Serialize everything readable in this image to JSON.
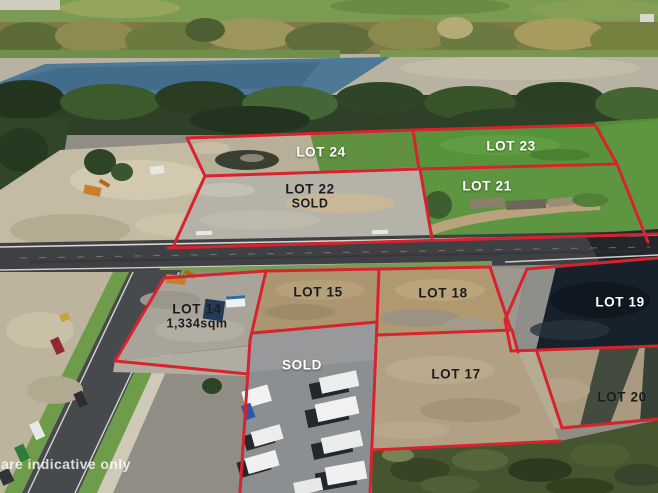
{
  "image": {
    "kind": "aerial-drone-photo-of-subdivision",
    "width_px": 658,
    "height_px": 493
  },
  "watermark": {
    "text": "are indicative only"
  },
  "palette": {
    "boundary_red": "#d8232e",
    "label_white": "#ffffff",
    "label_dark": "#1b1b1d",
    "river_blue": "#4e7996",
    "grass_green": "#57933a",
    "dirt_tan": "#c4bba4",
    "road_asphalt": "#3e4043"
  },
  "lots": [
    {
      "id": "lot-24",
      "label": "LOT 24",
      "label_color": "white"
    },
    {
      "id": "lot-23",
      "label": "LOT 23",
      "label_color": "white"
    },
    {
      "id": "lot-22",
      "label": "LOT 22",
      "status": "SOLD",
      "label_color": "dark"
    },
    {
      "id": "lot-21",
      "label": "LOT 21",
      "label_color": "white"
    },
    {
      "id": "lot-14",
      "label": "LOT 14",
      "area": "1,334sqm",
      "label_color": "dark"
    },
    {
      "id": "lot-15",
      "label": "LOT 15",
      "label_color": "dark"
    },
    {
      "id": "lot-18",
      "label": "LOT 18",
      "label_color": "dark"
    },
    {
      "id": "lot-19",
      "label": "LOT 19",
      "label_color": "white"
    },
    {
      "id": "sold-yard",
      "label": "SOLD",
      "label_color": "white"
    },
    {
      "id": "lot-17",
      "label": "LOT 17",
      "label_color": "dark"
    },
    {
      "id": "lot-20",
      "label": "LOT 20",
      "label_color": "dark"
    }
  ]
}
